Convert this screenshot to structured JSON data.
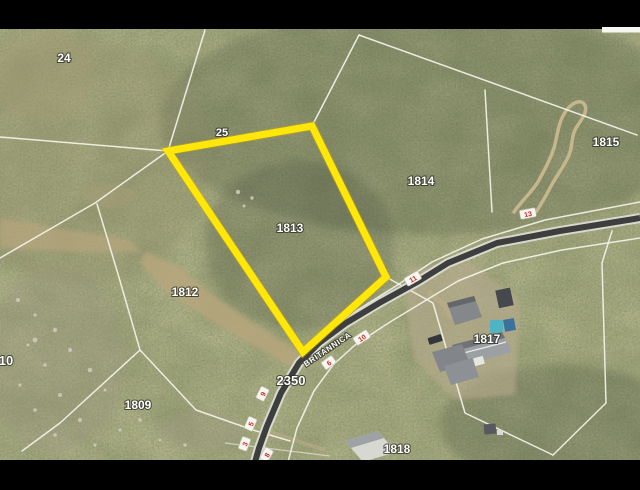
{
  "map": {
    "type": "aerial-cadastral-photo",
    "highlighted_parcel": "1813",
    "highlight_color": "#ffe70a",
    "boundary_line_color": "#f4f3ea",
    "road_color": "#3d3e3e",
    "marker_text_color": "#ce2b24",
    "label_text_color": "#ffffff",
    "letterbox_color": "#000000"
  },
  "labels": {
    "p24": "24",
    "p25": "25",
    "p1815": "1815",
    "p1814": "1814",
    "p1813": "1813",
    "p1812": "1812",
    "p1809": "1809",
    "p1817": "1817",
    "p1818": "1818",
    "p2350": "2350",
    "p10": "10",
    "road": "BRITANNICA"
  },
  "markers": [
    "13",
    "11",
    "10",
    "6",
    "9",
    "5",
    "3",
    "8"
  ]
}
